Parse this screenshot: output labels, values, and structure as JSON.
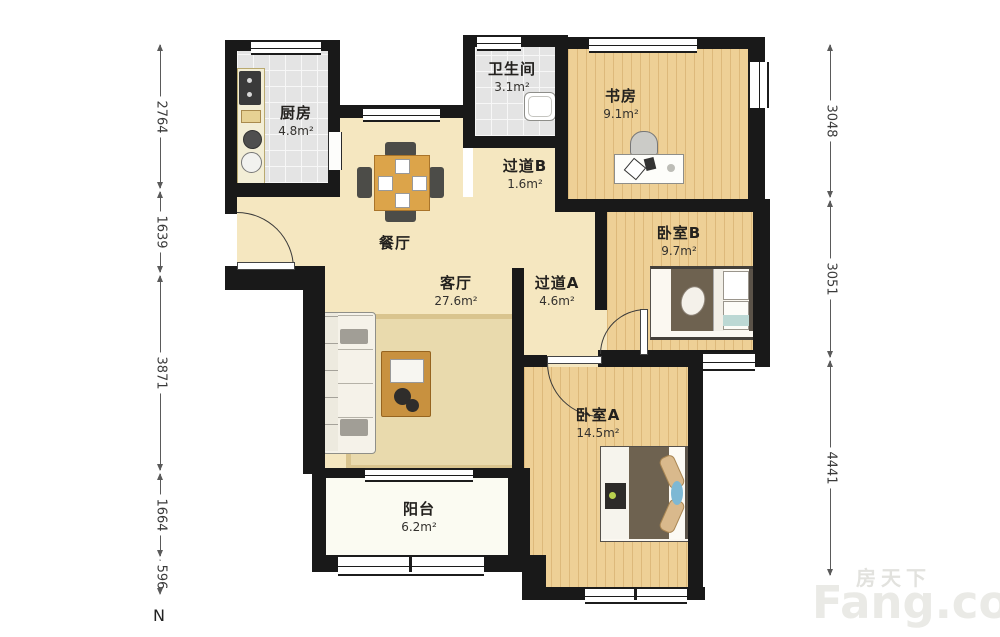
{
  "plan_title": "residential floor plan",
  "rooms": [
    {
      "name": "厨房",
      "area": "4.8m²"
    },
    {
      "name": "卫生间",
      "area": "3.1m²"
    },
    {
      "name": "书房",
      "area": "9.1m²"
    },
    {
      "name": "过道B",
      "area": "1.6m²"
    },
    {
      "name": "餐厅",
      "area": ""
    },
    {
      "name": "客厅",
      "area": "27.6m²"
    },
    {
      "name": "过道A",
      "area": "4.6m²"
    },
    {
      "name": "卧室B",
      "area": "9.7m²"
    },
    {
      "name": "卧室A",
      "area": "14.5m²"
    },
    {
      "name": "阳台",
      "area": "6.2m²"
    }
  ],
  "dimensions": {
    "left": [
      {
        "value": "2764"
      },
      {
        "value": "1639"
      },
      {
        "value": "3871"
      },
      {
        "value": "1664"
      },
      {
        "value": "596"
      }
    ],
    "right": [
      {
        "value": "3048"
      },
      {
        "value": "3051"
      },
      {
        "value": "4441"
      }
    ]
  },
  "compass": {
    "north_label": "N"
  },
  "watermark": {
    "cn": "房天下",
    "en": "Fang.com"
  },
  "colors": {
    "wall": "#191919",
    "floor_living": "#f5e7c0",
    "floor_wood": "#eed096",
    "floor_tile": "#e4e4e4",
    "floor_balcony": "#fbfbf2",
    "bed_blanket": "#6e6250",
    "pillow": "#d9b98c",
    "accent_blue": "#7db8d4",
    "watermark_gray": "#eaeae6"
  }
}
